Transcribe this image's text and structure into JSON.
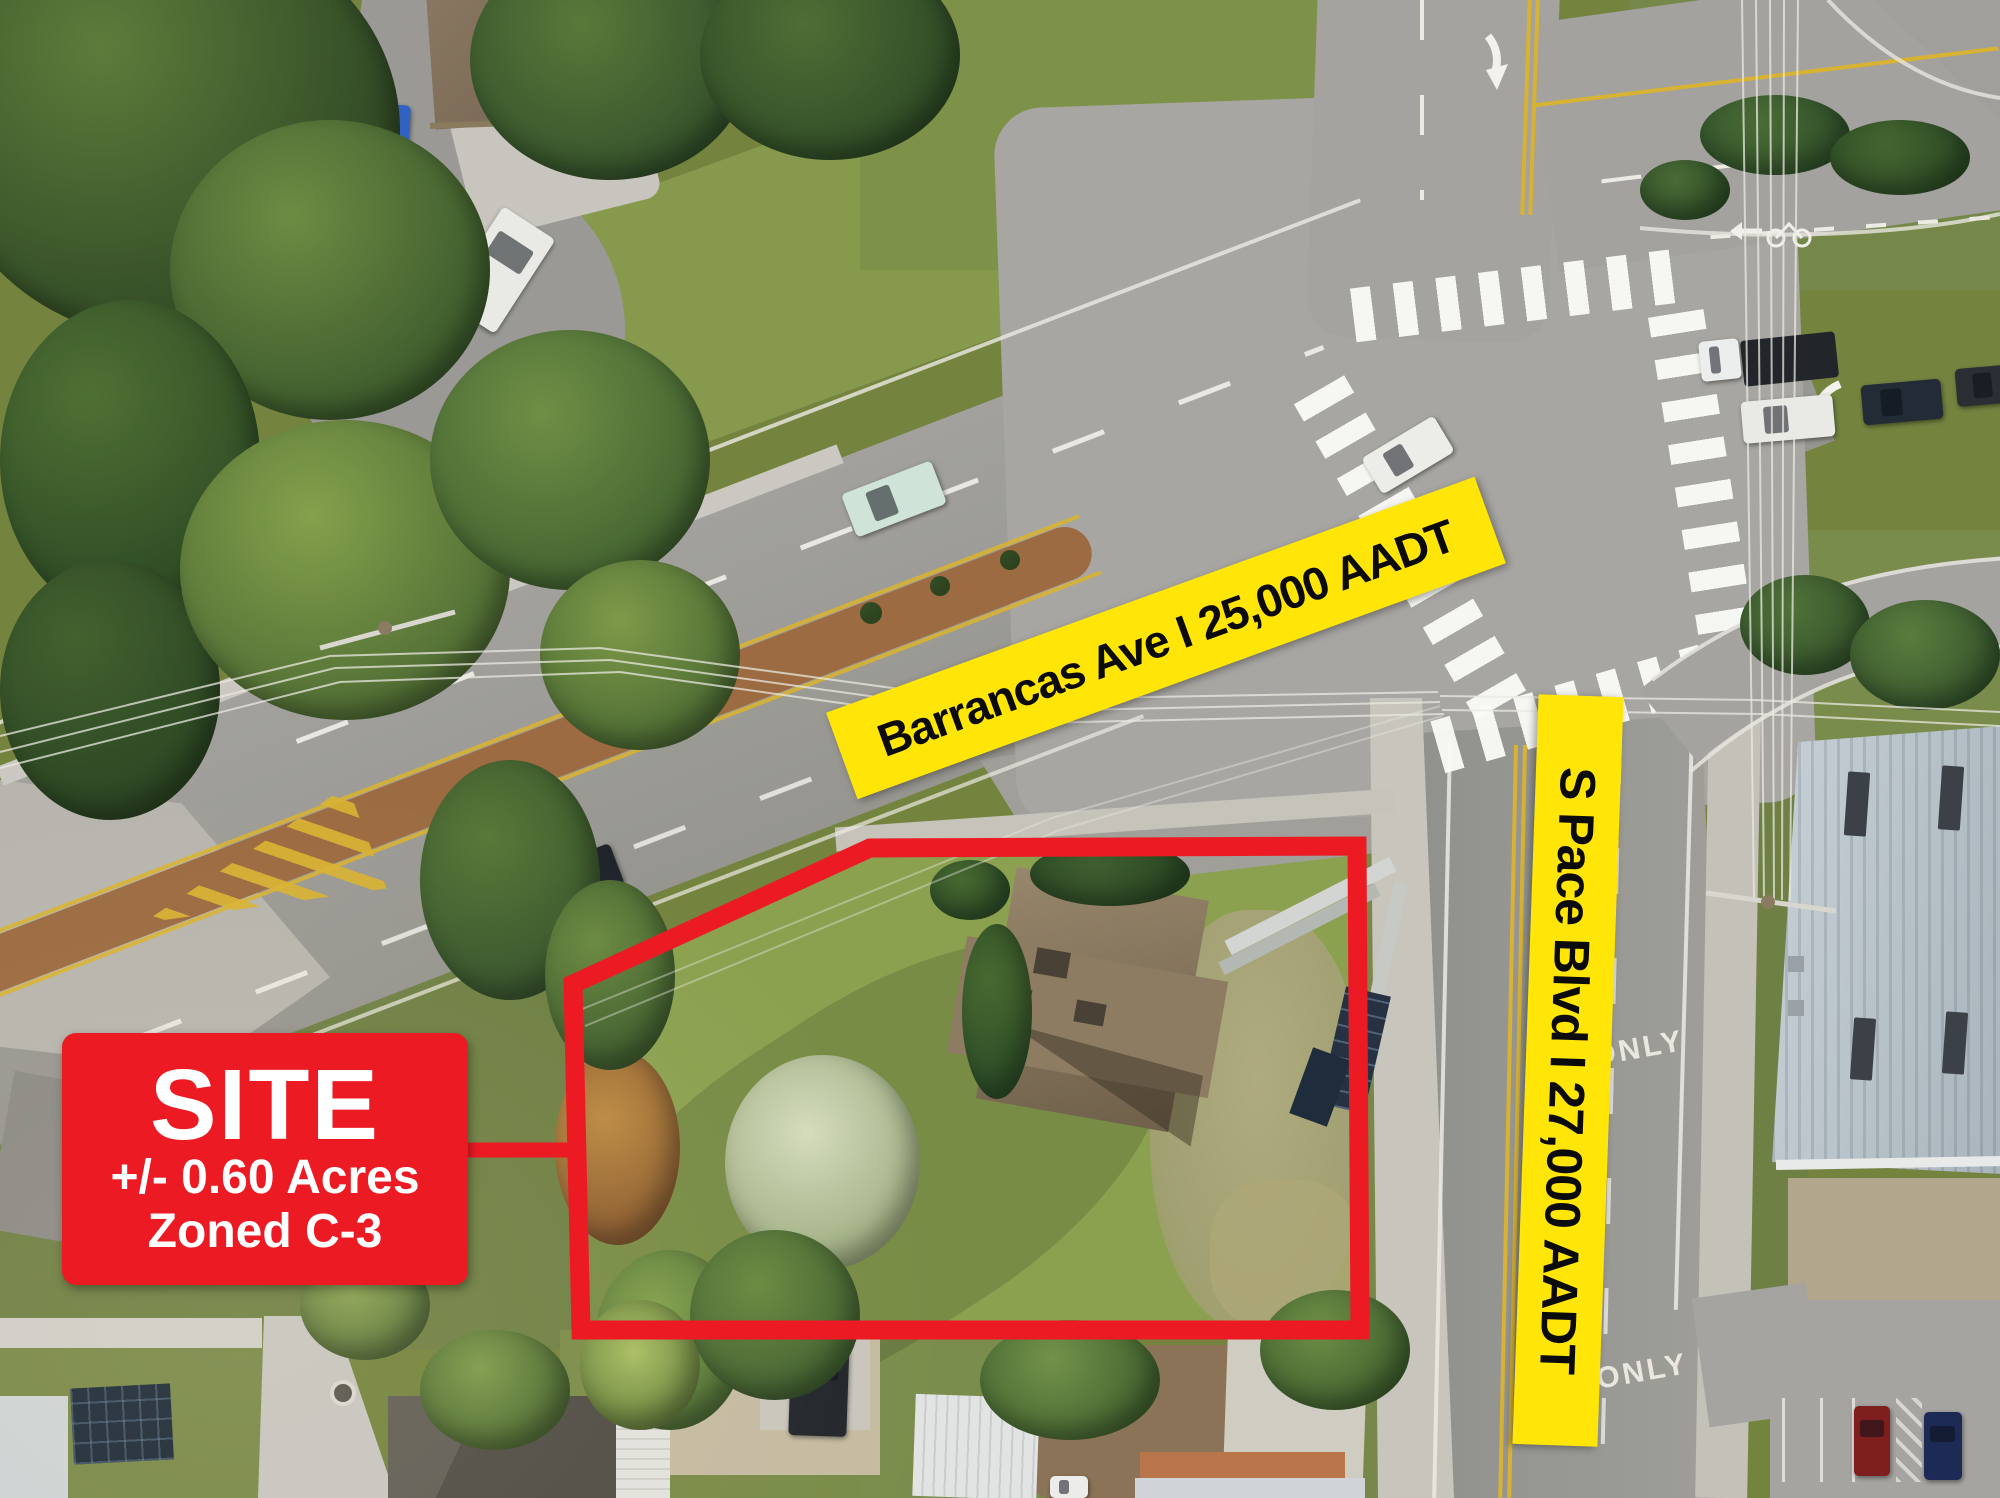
{
  "labels": {
    "barrancas": {
      "text": "Barrancas Ave I 25,000 AADT",
      "road": "Barrancas Ave",
      "aadt": "25,000 AADT"
    },
    "pace": {
      "text": "S Pace Blvd I 27,000 AADT",
      "road": "S Pace Blvd",
      "aadt": "27,000 AADT"
    }
  },
  "site_callout": {
    "title": "SITE",
    "acreage": "+/- 0.60 Acres",
    "zoning": "Zoned C-3"
  },
  "road_markings": {
    "only": "ONLY"
  },
  "colors": {
    "banner_bg": "#FFE608",
    "banner_text": "#0B0B0B",
    "callout_bg": "#EC1B23",
    "callout_text": "#FFFFFF",
    "boundary": "#EC1B23"
  }
}
